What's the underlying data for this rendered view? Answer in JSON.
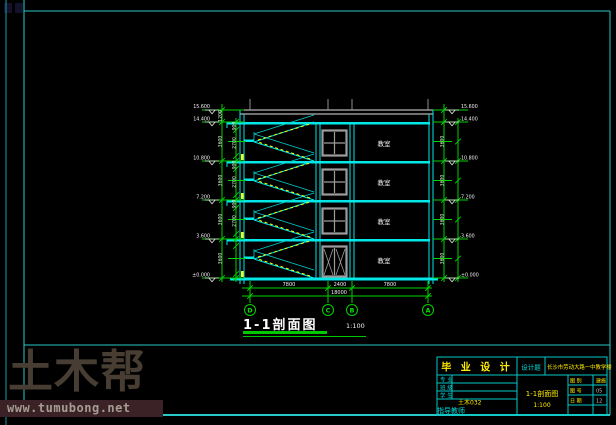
{
  "watermark": {
    "logo": "土木帮",
    "url": "www.tumubong.net"
  },
  "drawing": {
    "section_title": "1-1剖面图",
    "section_scale": "1:100",
    "rooms": [
      "教室",
      "教室",
      "教室",
      "教室"
    ],
    "axes": [
      "D",
      "C",
      "B",
      "A"
    ],
    "dims_bottom": {
      "segments": [
        "7800",
        "2400",
        "7800"
      ],
      "total": "18000"
    },
    "levels": [
      "15.600",
      "14.400",
      "10.800",
      "7.200",
      "3.600",
      "±0.000"
    ],
    "story_dims": [
      "3600",
      "3600",
      "3600",
      "3600"
    ],
    "parapet_dim": "1200",
    "sub_dims": [
      "900",
      "2700"
    ]
  },
  "titleblock": {
    "project": "毕 业 设 计",
    "title_label": "设计题",
    "title": "长沙市劳动大路一中教学楼",
    "rows": [
      {
        "label": "专 业"
      },
      {
        "label": "班 级"
      },
      {
        "label": "学 生"
      }
    ],
    "class_value": "土木032",
    "advisor_label": "指导教师",
    "drawing_name": "1-1剖面图",
    "drawing_scale": "1:100",
    "info": [
      {
        "label": "图 别",
        "value": "建施"
      },
      {
        "label": "图 号",
        "value": "05"
      },
      {
        "label": "日 期",
        "value": "12"
      }
    ]
  }
}
